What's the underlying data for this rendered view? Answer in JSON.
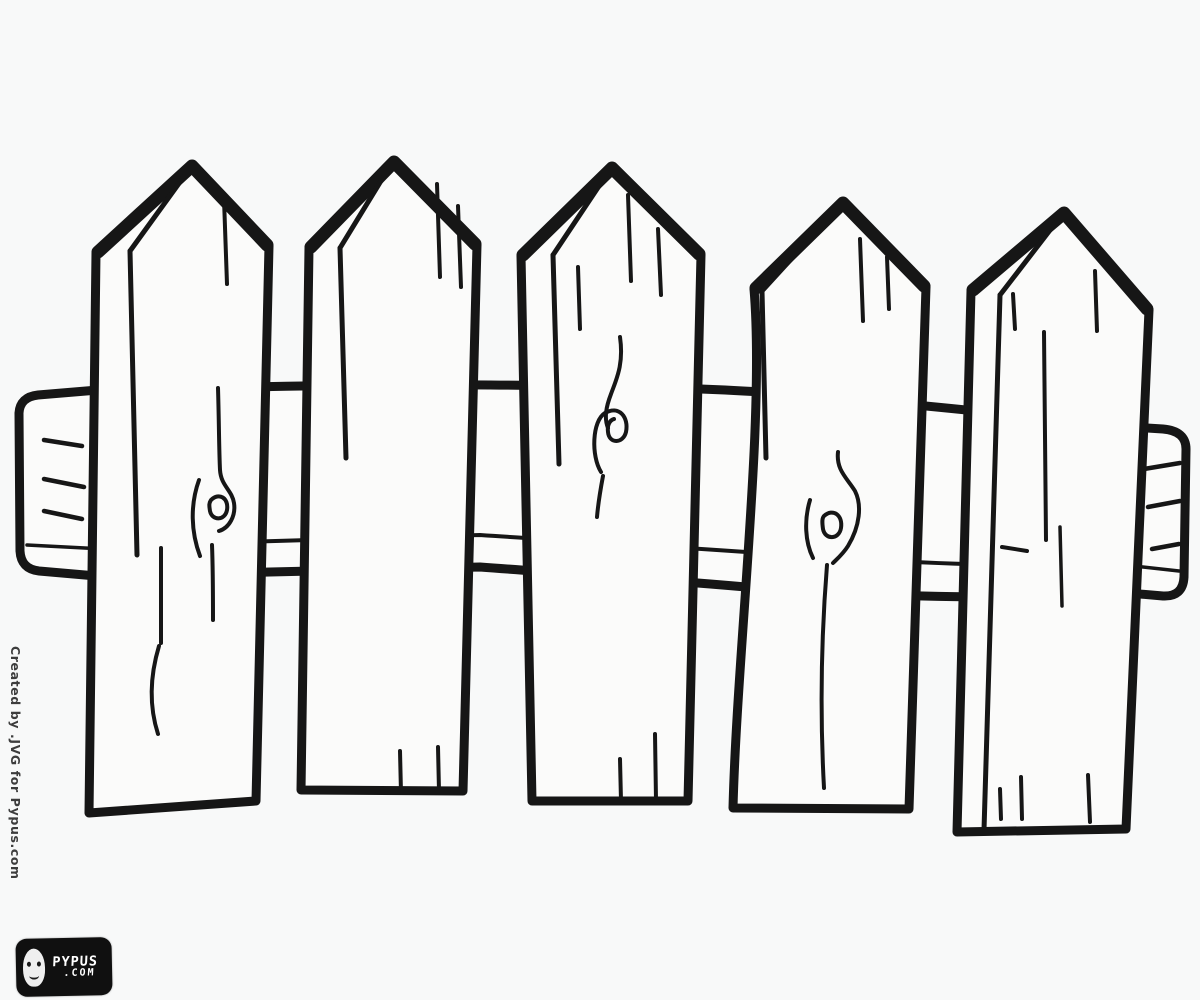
{
  "page": {
    "background_color": "#f8f9f9",
    "ink_color": "#161616"
  },
  "drawing": {
    "title": "Wooden picket fence coloring page",
    "style": "black-and-white line art, uncolored",
    "picket_count": 5,
    "rail": "one horizontal rail passing behind the pickets with rounded end caps on both sides",
    "wood_knot_count": 3
  },
  "watermark": {
    "credit": "Created by .JVG for Pypus.com"
  },
  "logo": {
    "name": "PYPUS",
    "tld": ".COM"
  }
}
